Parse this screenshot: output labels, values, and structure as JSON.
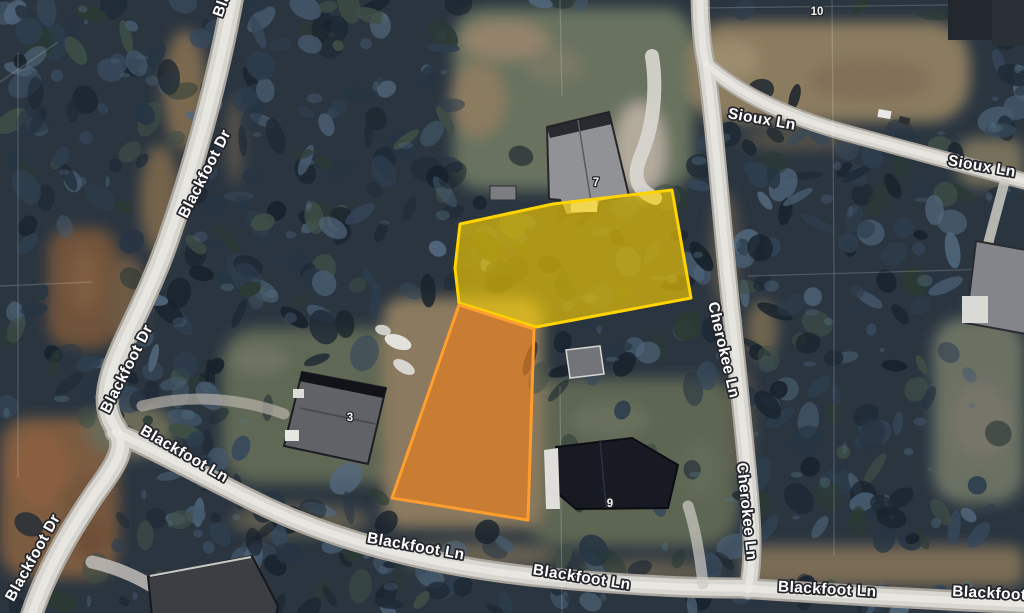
{
  "map": {
    "view_type": "aerial-satellite",
    "labels": {
      "blackfoot_dr_partial_top": "Blackfoot Dr",
      "blackfoot_dr_upper": "Blackfoot Dr",
      "blackfoot_dr_middle": "Blackfoot Dr",
      "blackfoot_dr_lower": "Blackfoot Dr",
      "blackfoot_ln_upper_left": "Blackfoot Ln",
      "blackfoot_ln_center_a": "Blackfoot Ln",
      "blackfoot_ln_center_b": "Blackfoot Ln",
      "blackfoot_ln_right": "Blackfoot Ln",
      "blackfoot_ln_partial_right": "Blackfoot Ln",
      "sioux_ln_west": "Sioux Ln",
      "sioux_ln_east": "Sioux Ln",
      "cherokee_ln_upper": "Cherokee Ln",
      "cherokee_ln_lower": "Cherokee Ln"
    },
    "house_numbers": {
      "lot_10": "10",
      "lot_7": "7",
      "lot_3": "3",
      "lot_9": "9"
    },
    "highlights": {
      "yellow_lot": {
        "fill_color": "#ffd400",
        "border_color": "#ffd400"
      },
      "orange_lot": {
        "fill_color": "#ee8019",
        "border_color": "#ff9d2e"
      }
    }
  }
}
